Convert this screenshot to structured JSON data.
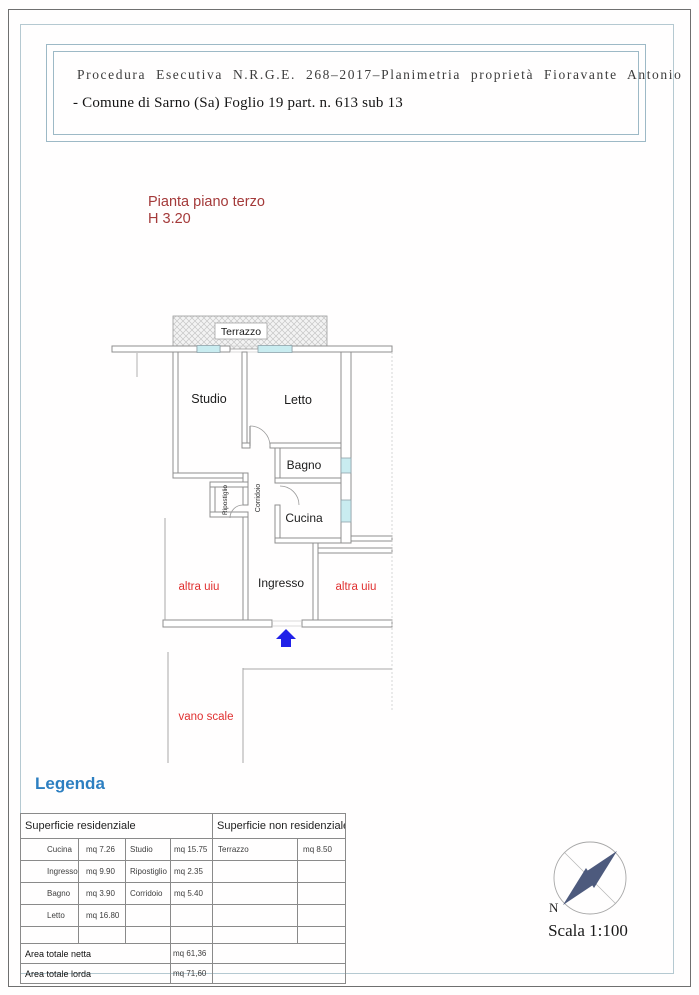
{
  "title_block": {
    "line1": "Procedura Esecutiva N.R.G.E. 268–2017–Planimetria proprietà Fioravante Antonio",
    "line2": "- Comune di Sarno (Sa) Foglio 19 part. n. 613 sub 13"
  },
  "plan_heading": {
    "line1": "Pianta piano terzo",
    "line2": "H 3.20"
  },
  "floor_plan": {
    "rooms": {
      "terrazzo": "Terrazzo",
      "studio": "Studio",
      "letto": "Letto",
      "bagno": "Bagno",
      "cucina": "Cucina",
      "ingresso": "Ingresso",
      "ripostiglio": "Ripostiglio",
      "corridoio": "Corridoio"
    },
    "annotations": {
      "altra_uiu_left": "altra uiu",
      "altra_uiu_right": "altra uiu",
      "vano_scale": "vano scale"
    },
    "colors": {
      "wall": "#8f8f8f",
      "window": "#c9ecf0",
      "red_label": "#e03030",
      "arrow": "#2121e8"
    }
  },
  "legend": {
    "heading": "Legenda",
    "table": {
      "header_residential": "Superficie residenziale",
      "header_non_residential": "Superficie non residenziale",
      "rows": [
        [
          "Cucina",
          "mq 7.26",
          "Studio",
          "mq 15.75",
          "Terrazzo",
          "mq 8.50"
        ],
        [
          "Ingresso",
          "mq 9.90",
          "Ripostiglio",
          "mq 2.35",
          "",
          ""
        ],
        [
          "Bagno",
          "mq 3.90",
          "Corridoio",
          "mq 5.40",
          "",
          ""
        ],
        [
          "Letto",
          "mq 16.80",
          "",
          "",
          "",
          ""
        ],
        [
          "",
          "",
          "",
          "",
          "",
          ""
        ]
      ],
      "totals": [
        {
          "label": "Area totale netta",
          "value": "mq 61,36"
        },
        {
          "label": "Area totale lorda",
          "value": "mq 71,60"
        }
      ]
    }
  },
  "compass": {
    "north_label": "N",
    "scale_label": "Scala 1:100",
    "needle_color": "#4d5a7d"
  }
}
